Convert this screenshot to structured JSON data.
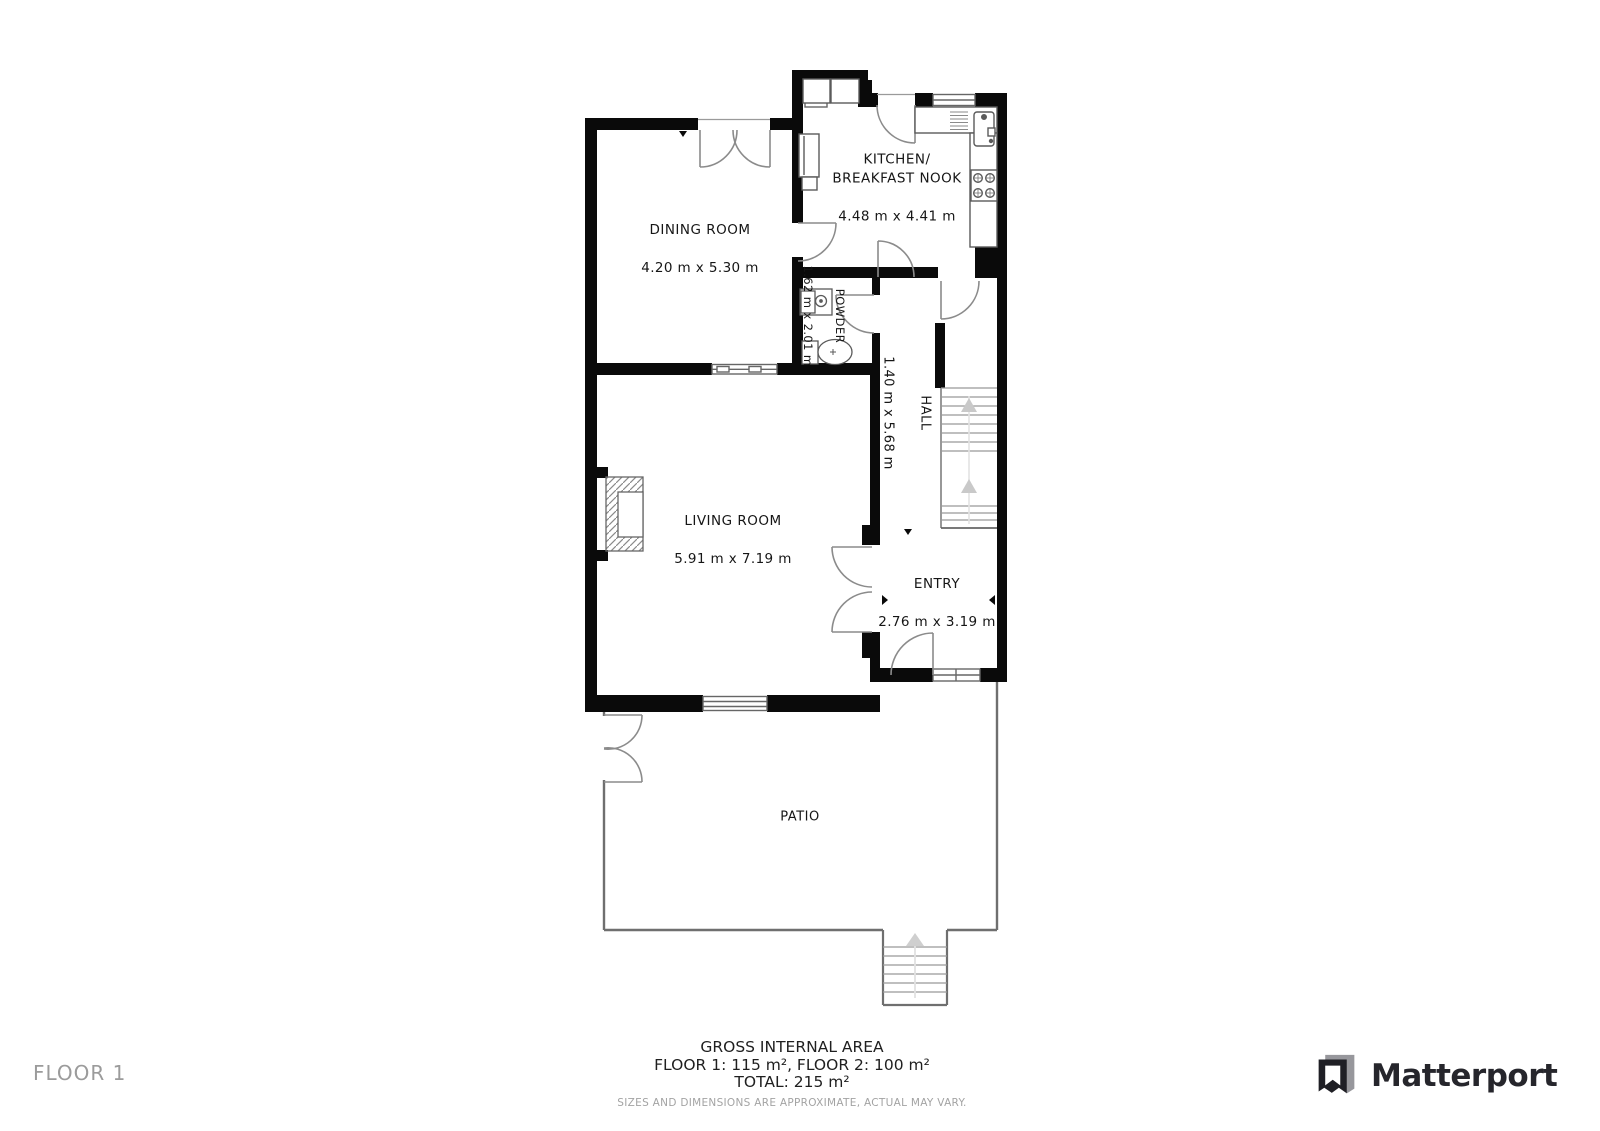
{
  "plan": {
    "rooms": {
      "dining": {
        "name": "DINING ROOM",
        "dims": "4.20 m x 5.30 m"
      },
      "kitchen": {
        "name": "KITCHEN/\nBREAKFAST NOOK",
        "dims": "4.48 m x 4.41 m"
      },
      "powder": {
        "name": "POWDER",
        "dims": "1.62 m x 2.01 m"
      },
      "hall": {
        "name": "HALL",
        "dims": "1.40 m x 5.68 m"
      },
      "living": {
        "name": "LIVING ROOM",
        "dims": "5.91 m x 7.19 m"
      },
      "entry": {
        "name": "ENTRY",
        "dims": "2.76 m x 3.19 m"
      },
      "patio": {
        "name": "PATIO"
      }
    }
  },
  "footer": {
    "title": "GROSS INTERNAL AREA",
    "floors": "FLOOR 1: 115 m², FLOOR 2: 100 m²",
    "total": "TOTAL: 215 m²",
    "disclaimer": "SIZES AND DIMENSIONS ARE APPROXIMATE, ACTUAL MAY VARY."
  },
  "floor_label": "FLOOR 1",
  "brand": {
    "name": "Matterport"
  },
  "colors": {
    "wall": "#0a0a0a",
    "thin_wall": "#6f6f6f",
    "door_arc": "#8b8b8b",
    "fixture": "#5a5a5a",
    "stair_arrow": "#c9c9c9",
    "label_text": "#161616",
    "muted_text": "#9b9b9b",
    "brand_text": "#26262c"
  }
}
